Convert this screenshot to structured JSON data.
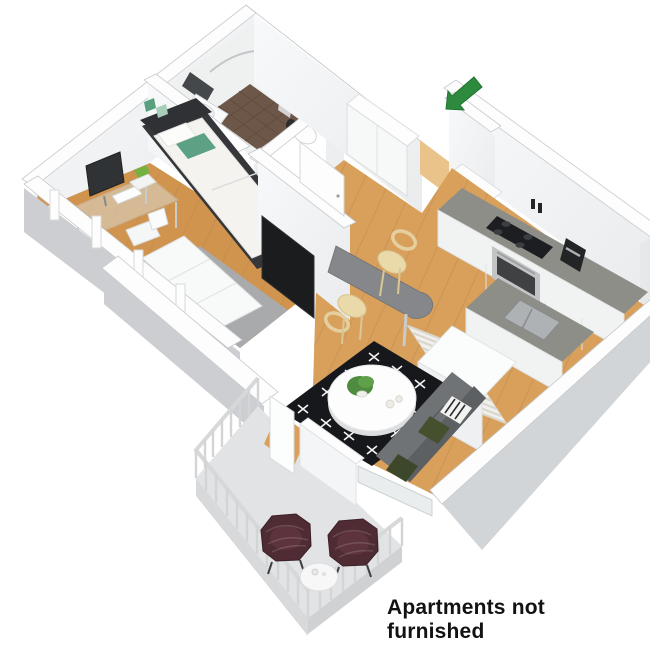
{
  "figure": {
    "caption": "Apartments not furnished"
  },
  "icons": {
    "entrance_arrow": "thick-arrow-pointing-down-left-at-entrance-door"
  },
  "colors": {
    "background": "#ffffff",
    "ink": "#121212",
    "arrow_green": "#2e8b3d",
    "wall_top": "#fdfdfd",
    "wall_shade": "#eceef0",
    "wall_outer": "#d2d5d7",
    "skirt": "#ccced1",
    "wood": "#d9a05c",
    "wood_seam": "#b9854a",
    "rug_gray": "#a8aaac",
    "rug_black": "#17181b",
    "rug_mark": "#f5f5f5",
    "rug_stripe_base": "#f1f0ec",
    "rug_stripe_line": "#d9d6cd",
    "tile": "#6d5748",
    "bed_frame": "#35373a",
    "duvet": "#f4f3f0",
    "pillow_green": "#5ca183",
    "monitor": "#303335",
    "tv": "#1b1c1e",
    "mirror": "#45484b",
    "sofa": "#707376",
    "sofa_back": "#5d6063",
    "pillow_olive": "#44502e",
    "chair_cream": "#ead9a9",
    "chair_trim": "#d6c391",
    "bar_table": "#85878a",
    "counter": "#8e8e88",
    "cabinet": "#f7f8f8",
    "appliance": "#1d1e21",
    "steel": "#c2c4c6",
    "balcony_floor": "#e2e3e4",
    "railing": "#d2d4d6",
    "wicker": "#4f2b34",
    "table_white": "#f7f7f7",
    "plant": "#4f8c3f"
  }
}
